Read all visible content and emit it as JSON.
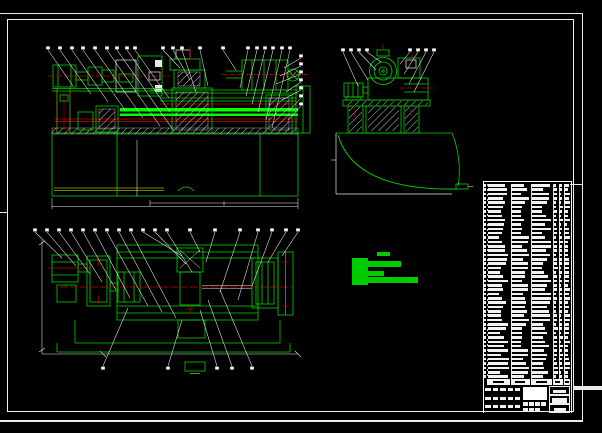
{
  "colors": {
    "background": "#000000",
    "green": "#00d400",
    "bright_green": "#00ff00",
    "red": "#c40000",
    "yellow": "#a8a800",
    "white": "#e9e9e9"
  },
  "views": {
    "front": {
      "label": "front-assembly-view"
    },
    "side": {
      "label": "end-view-with-chip-tray"
    },
    "plan": {
      "label": "top-plan-view"
    }
  },
  "callouts": {
    "balloon_w": 3.6,
    "balloon_h": 3.0,
    "legible": false,
    "groups": [
      {
        "id": "front-top",
        "blob": "start",
        "leaders": [
          [
            48,
            50,
            73,
            86
          ],
          [
            60,
            50,
            91,
            94
          ],
          [
            72,
            50,
            108,
            102
          ],
          [
            83,
            50,
            125,
            110
          ],
          [
            95,
            50,
            143,
            118
          ],
          [
            107,
            50,
            160,
            126
          ],
          [
            117,
            50,
            174,
            131
          ],
          [
            127,
            50,
            170,
            112
          ],
          [
            135,
            50,
            169,
            98
          ],
          [
            163,
            50,
            180,
            68
          ],
          [
            173,
            50,
            190,
            80
          ],
          [
            182,
            50,
            196,
            92
          ],
          [
            200,
            50,
            208,
            86
          ],
          [
            223,
            50,
            236,
            70
          ],
          [
            248,
            50,
            240,
            88
          ],
          [
            257,
            50,
            246,
            96
          ],
          [
            265,
            50,
            252,
            104
          ],
          [
            273,
            50,
            258,
            112
          ],
          [
            282,
            50,
            266,
            120
          ],
          [
            290,
            50,
            272,
            128
          ]
        ]
      },
      {
        "id": "front-right",
        "blob": "start",
        "leaders": [
          [
            301,
            58,
            284,
            68
          ],
          [
            301,
            66,
            280,
            76
          ],
          [
            301,
            74,
            276,
            84
          ],
          [
            301,
            82,
            286,
            92
          ],
          [
            301,
            90,
            282,
            100
          ],
          [
            301,
            98,
            290,
            110
          ],
          [
            301,
            106,
            288,
            120
          ]
        ]
      },
      {
        "id": "side-top",
        "blob": "start",
        "leaders": [
          [
            343,
            52,
            358,
            86
          ],
          [
            351,
            52,
            368,
            80
          ],
          [
            359,
            52,
            376,
            70
          ],
          [
            367,
            52,
            381,
            62
          ],
          [
            410,
            52,
            400,
            64
          ],
          [
            418,
            52,
            404,
            74
          ],
          [
            426,
            52,
            409,
            84
          ],
          [
            434,
            52,
            414,
            92
          ]
        ]
      },
      {
        "id": "plan-top",
        "blob": "start",
        "leaders": [
          [
            35,
            232,
            62,
            258
          ],
          [
            47,
            232,
            76,
            266
          ],
          [
            59,
            232,
            90,
            274
          ],
          [
            71,
            232,
            102,
            282
          ],
          [
            83,
            232,
            116,
            290
          ],
          [
            95,
            232,
            130,
            298
          ],
          [
            107,
            232,
            148,
            306
          ],
          [
            119,
            232,
            162,
            312
          ],
          [
            131,
            232,
            176,
            318
          ],
          [
            143,
            232,
            182,
            256
          ],
          [
            155,
            232,
            186,
            264
          ],
          [
            167,
            232,
            192,
            272
          ],
          [
            190,
            232,
            200,
            252
          ],
          [
            215,
            232,
            206,
            262
          ],
          [
            240,
            232,
            220,
            292
          ],
          [
            258,
            232,
            238,
            300
          ],
          [
            272,
            232,
            252,
            286
          ],
          [
            286,
            232,
            268,
            262
          ],
          [
            298,
            232,
            282,
            256
          ]
        ]
      },
      {
        "id": "plan-bottom",
        "blob": "start-below",
        "leaders": [
          [
            103,
            366,
            128,
            308
          ],
          [
            168,
            366,
            182,
            320
          ],
          [
            217,
            366,
            200,
            310
          ],
          [
            232,
            366,
            208,
            300
          ],
          [
            252,
            366,
            220,
            290
          ]
        ]
      }
    ]
  },
  "tech_note": {
    "color": "#00cc00",
    "legible": false,
    "blocks": [
      [
        377,
        252,
        13,
        4
      ],
      [
        352,
        258,
        16,
        27
      ],
      [
        368,
        261,
        33,
        6
      ],
      [
        368,
        271,
        16,
        5
      ],
      [
        365,
        277,
        53,
        6
      ]
    ]
  },
  "bom": {
    "legible": false,
    "rows": 45,
    "row_height": 4.345,
    "bar_height": 2.6,
    "seed": 11,
    "columns": [
      {
        "x": 0,
        "w": 3.5,
        "kind": "seq"
      },
      {
        "x": 3.5,
        "w": 23.5,
        "kind": "text"
      },
      {
        "x": 27,
        "w": 20.5,
        "kind": "text"
      },
      {
        "x": 47.5,
        "w": 22,
        "kind": "text"
      },
      {
        "x": 69.5,
        "w": 5.5,
        "kind": "num"
      },
      {
        "x": 75,
        "w": 5,
        "kind": "num"
      },
      {
        "x": 80,
        "w": 7.5,
        "kind": "num"
      }
    ],
    "dividers": [
      3.5,
      27,
      47.5,
      69.5,
      75,
      80
    ]
  },
  "title_block": {
    "legible": false,
    "header_cells": [
      [
        3.5,
        23.5
      ],
      [
        27,
        20.5
      ],
      [
        47.5,
        22
      ],
      [
        69.5,
        10.5
      ],
      [
        80,
        7.5
      ]
    ],
    "left_bars": {
      "rows": 3,
      "cols": 5,
      "row_y": [
        3.5,
        12,
        20.5
      ],
      "col_x": [
        1.5,
        9,
        16.5,
        24,
        31
      ],
      "w": 5.5,
      "h": 3
    },
    "sub_bars": {
      "rows": [
        [
          39.5,
          17.5,
          4
        ],
        [
          39.5,
          23,
          3
        ]
      ],
      "w": 4.6,
      "h": 3.4,
      "gap": 6
    },
    "right_boxes": [
      {
        "x": 65.5,
        "y": 1.5,
        "w": 21,
        "h": 8.5,
        "bar": [
          3,
          2.5,
          13,
          3.5
        ]
      },
      {
        "x": 65.5,
        "y": 10.5,
        "w": 21,
        "h": 8.5,
        "bar": [
          2,
          2,
          15,
          4.5
        ]
      },
      {
        "x": 65.5,
        "y": 19.5,
        "w": 21,
        "h": 8.5,
        "bar": [
          3.5,
          2.5,
          12,
          3.5
        ]
      }
    ]
  }
}
